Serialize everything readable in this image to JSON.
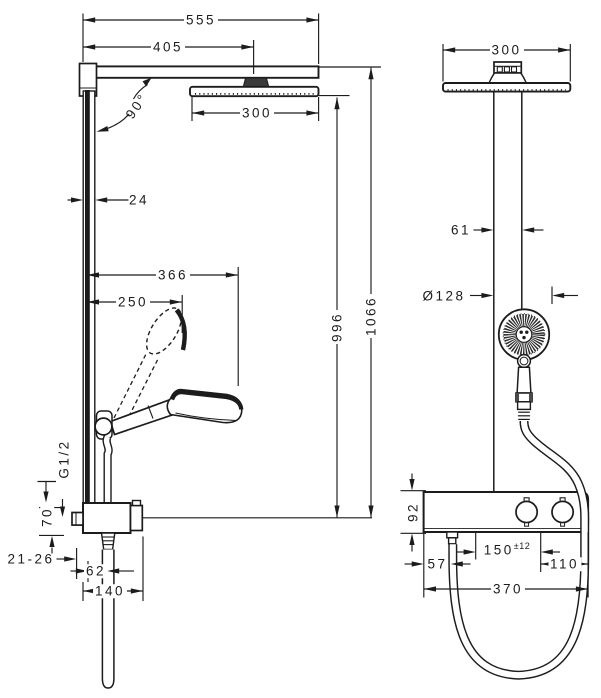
{
  "drawing": {
    "line_color": "#1c1c1c",
    "background": "#ffffff",
    "side_view": {
      "dim_total_width": "555",
      "dim_arm_projection": "405",
      "dim_headspray_width": "300",
      "dim_swivel_angle": "90°",
      "dim_profile_depth": "24",
      "dim_max_reach": "366",
      "dim_handshower_reach": "250",
      "dim_thread_size": "G1/2",
      "dim_inlet_offset": "70",
      "dim_wall_thickness_range": "21-26",
      "dim_hose_outlet_offset": "62",
      "dim_valve_depth": "140",
      "dim_height_to_headspray": "996",
      "dim_overall_height": "1066"
    },
    "front_view": {
      "dim_headspray_width": "300",
      "dim_pipe_offset": "61",
      "dim_handshower_diameter": "Ø128",
      "dim_valve_body_height": "92",
      "dim_supply_left_offset": "57",
      "dim_supply_spacing_value": "150",
      "dim_supply_spacing_tolerance": "±12",
      "dim_outlet_right_offset": "110",
      "dim_valve_body_width": "370"
    }
  }
}
